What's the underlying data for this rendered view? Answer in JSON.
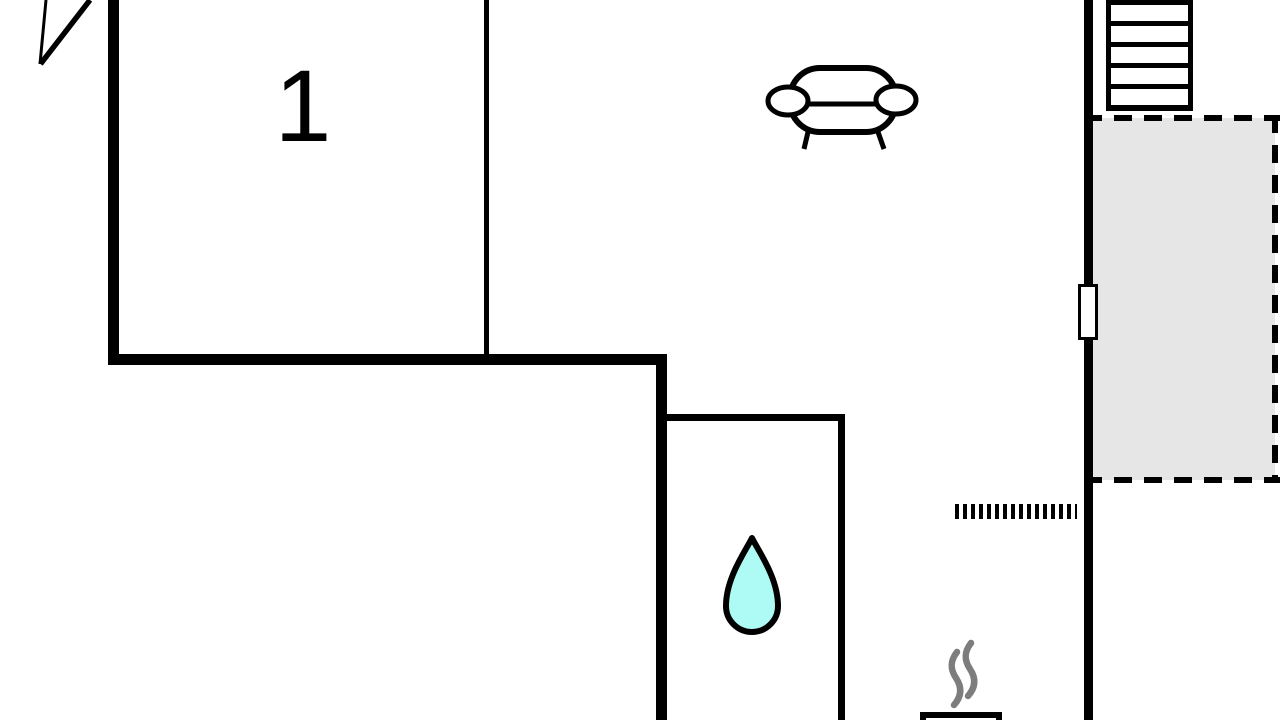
{
  "plan": {
    "type": "floor-plan",
    "room1": {
      "label": "1"
    },
    "icons": {
      "north_arrow": "north-arrow-icon",
      "sofa": "sofa-icon",
      "stairs": "staircase",
      "window": "window-marker",
      "terrace": "dashed-terrace",
      "opening": "dotted-opening",
      "water_drop": "water-drop-icon",
      "steam": "steam-icon",
      "stove": "stove"
    },
    "colors": {
      "wall": "#000000",
      "background": "#ffffff",
      "terrace_fill": "#e6e6e6",
      "water_drop_fill": "#aefaf5",
      "steam_stroke": "#7d7d7d"
    }
  }
}
